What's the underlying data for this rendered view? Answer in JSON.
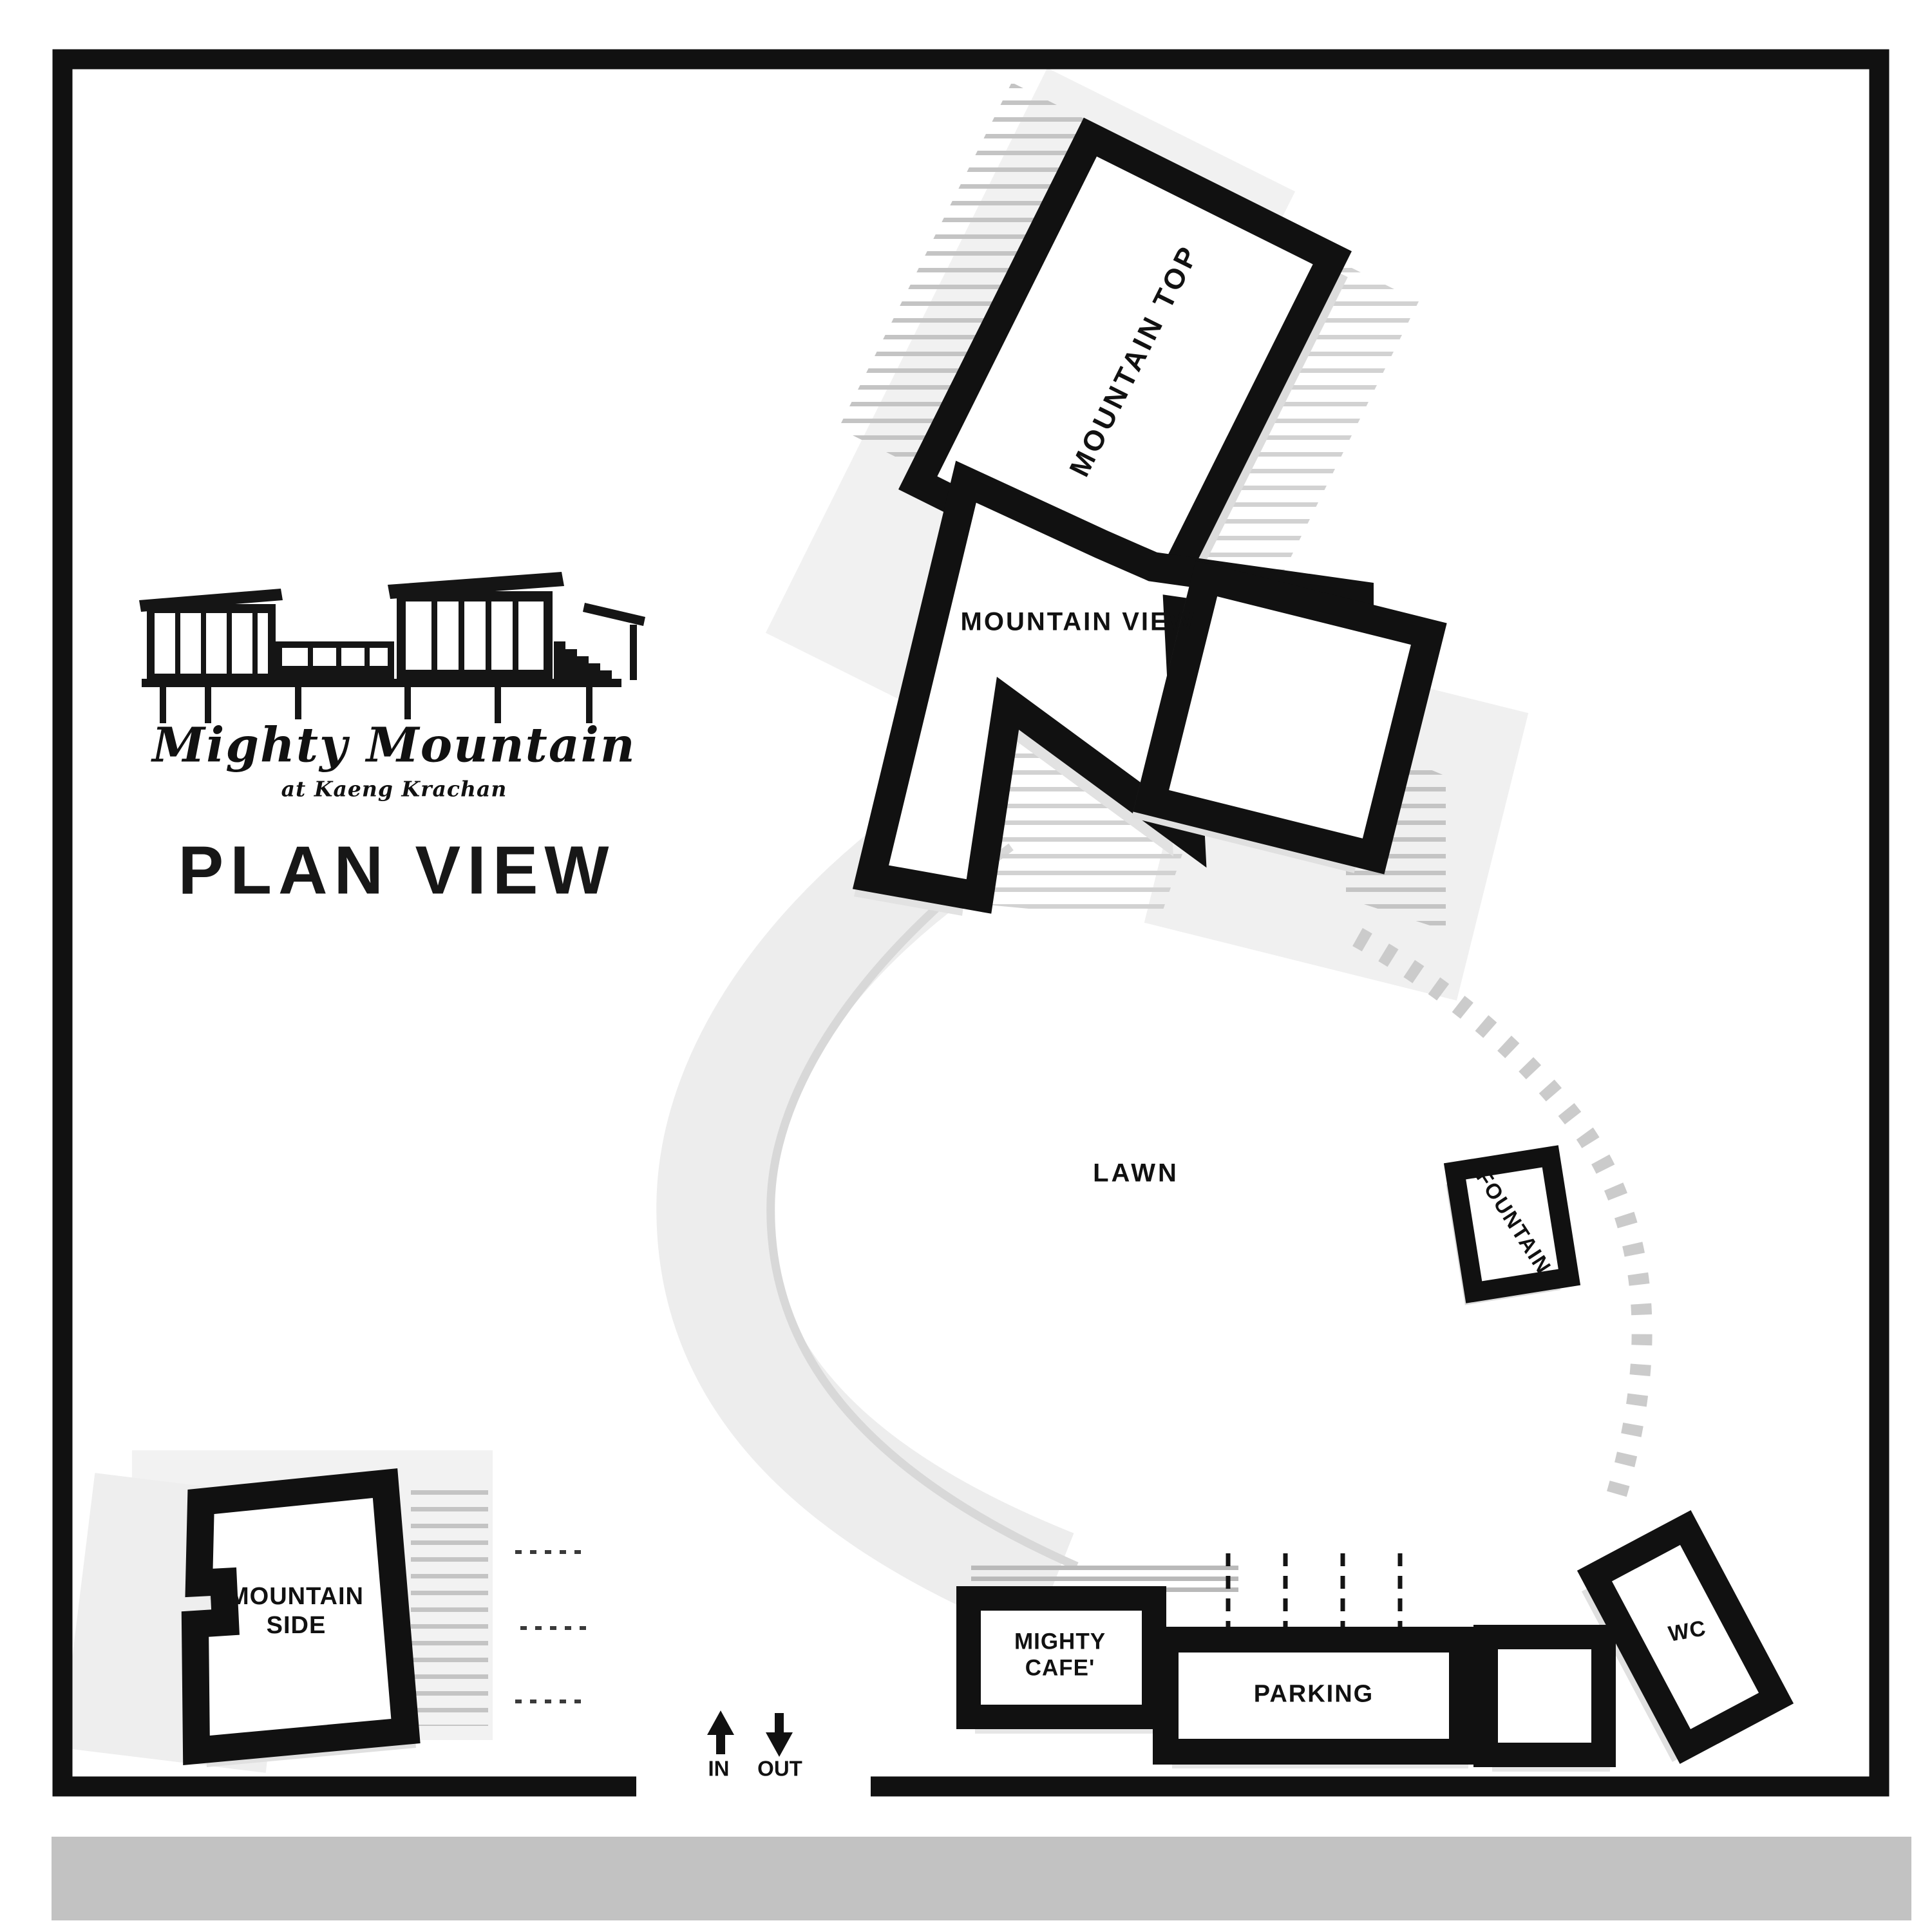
{
  "logo": {
    "brand": "Mighty Mountain",
    "tagline": "at Kaeng Krachan",
    "icon": "house-illustration-icon"
  },
  "title": "PLAN VIEW",
  "labels": {
    "mountain_top": "MOUNTAIN TOP",
    "mountain_view": "MOUNTAIN VIEW",
    "mountain_side_line1": "MOUNTAIN",
    "mountain_side_line2": "SIDE",
    "lawn": "LAWN",
    "fountain": "FOUNTAIN",
    "cafe_line1": "MIGHTY",
    "cafe_line2": "CAFE'",
    "parking": "PARKING",
    "wc": "WC",
    "entrance_in": "IN",
    "entrance_out": "OUT"
  },
  "icons": {
    "entrance_in": "arrow-up-icon",
    "entrance_out": "arrow-down-icon"
  },
  "colors": {
    "ink": "#111111",
    "road_gray": "#c2c2c2",
    "walkway_gray": "#ededed",
    "hatch_gray": "#c7c7c7",
    "pale_gray": "#f0f0f0"
  }
}
